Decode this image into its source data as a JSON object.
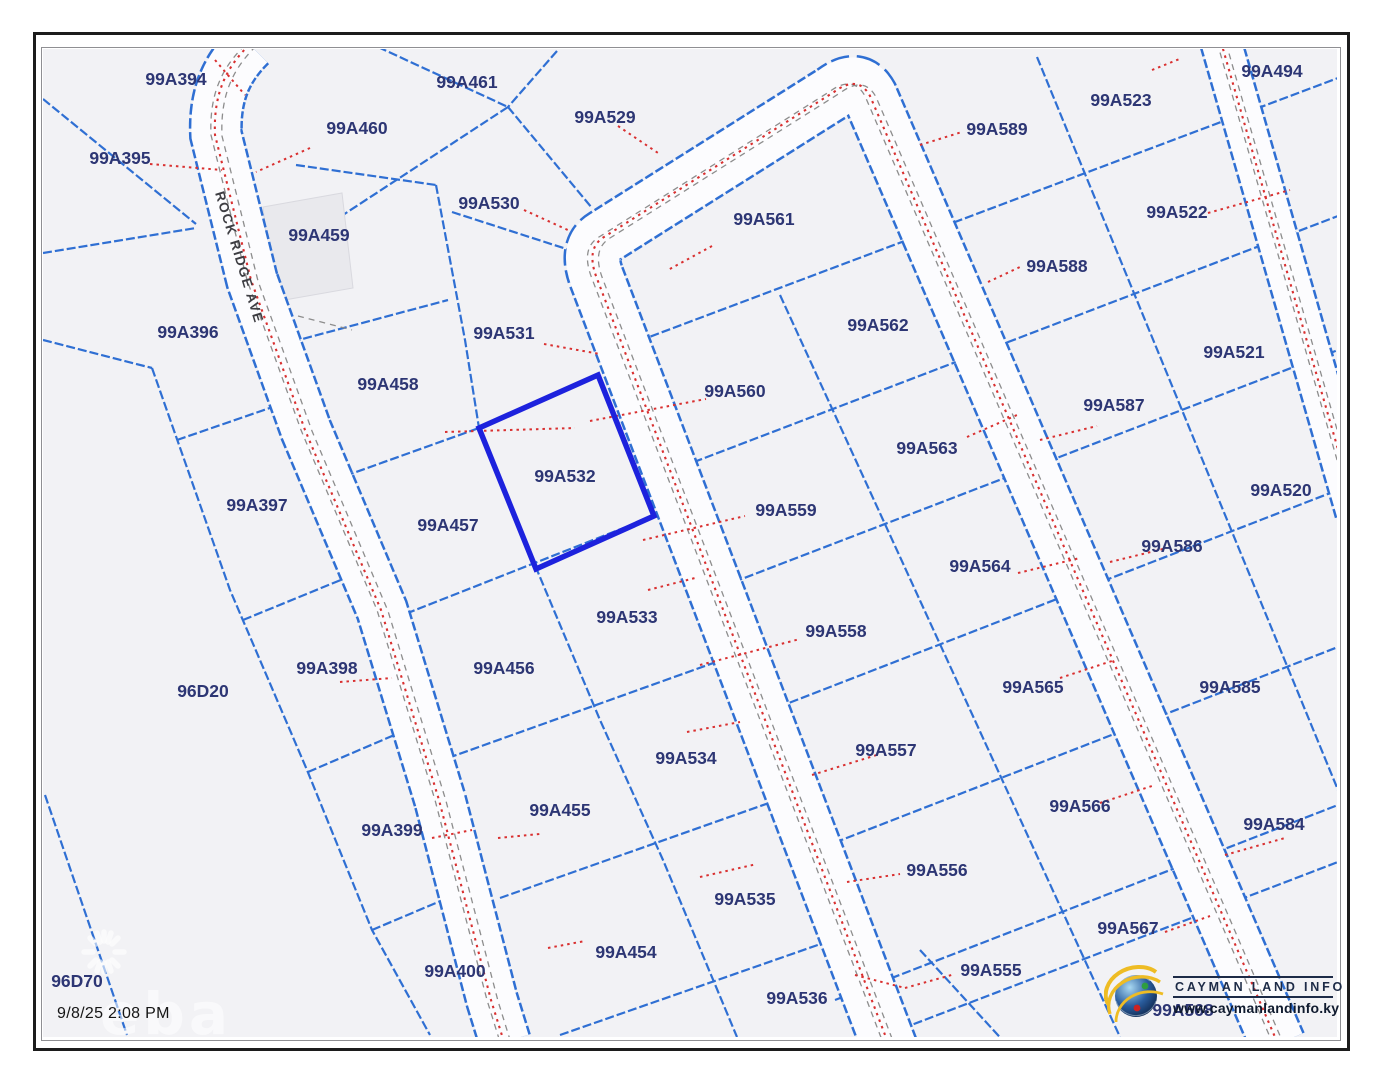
{
  "map": {
    "road_name": "ROCK RIDGE AVE",
    "selected_parcel_id": "99A532",
    "timestamp": "9/8/25 2:08 PM",
    "watermark_text": "eba",
    "parcel_labels": [
      {
        "id": "99A394",
        "x": 176,
        "y": 79
      },
      {
        "id": "99A395",
        "x": 120,
        "y": 158
      },
      {
        "id": "99A396",
        "x": 188,
        "y": 332
      },
      {
        "id": "99A397",
        "x": 257,
        "y": 505
      },
      {
        "id": "99A398",
        "x": 327,
        "y": 668
      },
      {
        "id": "99A399",
        "x": 392,
        "y": 830
      },
      {
        "id": "99A400",
        "x": 455,
        "y": 971
      },
      {
        "id": "96D20",
        "x": 203,
        "y": 691
      },
      {
        "id": "96D70",
        "x": 77,
        "y": 981
      },
      {
        "id": "99A461",
        "x": 467,
        "y": 82
      },
      {
        "id": "99A460",
        "x": 357,
        "y": 128
      },
      {
        "id": "99A459",
        "x": 319,
        "y": 235
      },
      {
        "id": "99A458",
        "x": 388,
        "y": 384
      },
      {
        "id": "99A457",
        "x": 448,
        "y": 525
      },
      {
        "id": "99A456",
        "x": 504,
        "y": 668
      },
      {
        "id": "99A455",
        "x": 560,
        "y": 810
      },
      {
        "id": "99A454",
        "x": 626,
        "y": 952
      },
      {
        "id": "99A529",
        "x": 605,
        "y": 117
      },
      {
        "id": "99A530",
        "x": 489,
        "y": 203
      },
      {
        "id": "99A531",
        "x": 504,
        "y": 333
      },
      {
        "id": "99A532",
        "x": 565,
        "y": 476
      },
      {
        "id": "99A533",
        "x": 627,
        "y": 617
      },
      {
        "id": "99A534",
        "x": 686,
        "y": 758
      },
      {
        "id": "99A535",
        "x": 745,
        "y": 899
      },
      {
        "id": "99A536",
        "x": 797,
        "y": 998
      },
      {
        "id": "99A561",
        "x": 764,
        "y": 219
      },
      {
        "id": "99A560",
        "x": 735,
        "y": 391
      },
      {
        "id": "99A559",
        "x": 786,
        "y": 510
      },
      {
        "id": "99A558",
        "x": 836,
        "y": 631
      },
      {
        "id": "99A557",
        "x": 886,
        "y": 750
      },
      {
        "id": "99A556",
        "x": 937,
        "y": 870
      },
      {
        "id": "99A555",
        "x": 991,
        "y": 970
      },
      {
        "id": "99A562",
        "x": 878,
        "y": 325
      },
      {
        "id": "99A563",
        "x": 927,
        "y": 448
      },
      {
        "id": "99A564",
        "x": 980,
        "y": 566
      },
      {
        "id": "99A565",
        "x": 1033,
        "y": 687
      },
      {
        "id": "99A566",
        "x": 1080,
        "y": 806
      },
      {
        "id": "99A567",
        "x": 1128,
        "y": 928
      },
      {
        "id": "99A568",
        "x": 1183,
        "y": 1010
      },
      {
        "id": "99A589",
        "x": 997,
        "y": 129
      },
      {
        "id": "99A588",
        "x": 1057,
        "y": 266
      },
      {
        "id": "99A587",
        "x": 1114,
        "y": 405
      },
      {
        "id": "99A586",
        "x": 1172,
        "y": 546
      },
      {
        "id": "99A585",
        "x": 1230,
        "y": 687
      },
      {
        "id": "99A584",
        "x": 1274,
        "y": 824
      },
      {
        "id": "99A523",
        "x": 1121,
        "y": 100
      },
      {
        "id": "99A522",
        "x": 1177,
        "y": 212
      },
      {
        "id": "99A521",
        "x": 1234,
        "y": 352
      },
      {
        "id": "99A520",
        "x": 1281,
        "y": 490
      },
      {
        "id": "99A494",
        "x": 1272,
        "y": 71
      }
    ]
  },
  "logo": {
    "title": "CAYMAN LAND INFO",
    "website": "www.caymanlandinfo.ky"
  },
  "colors": {
    "parcel_line": "#2f6fd3",
    "selected_parcel": "#1d22dd",
    "label_text": "#2d3674",
    "tie_line": "#d93030",
    "map_background": "#f2f2f5",
    "frame": "#1c1c1c"
  }
}
